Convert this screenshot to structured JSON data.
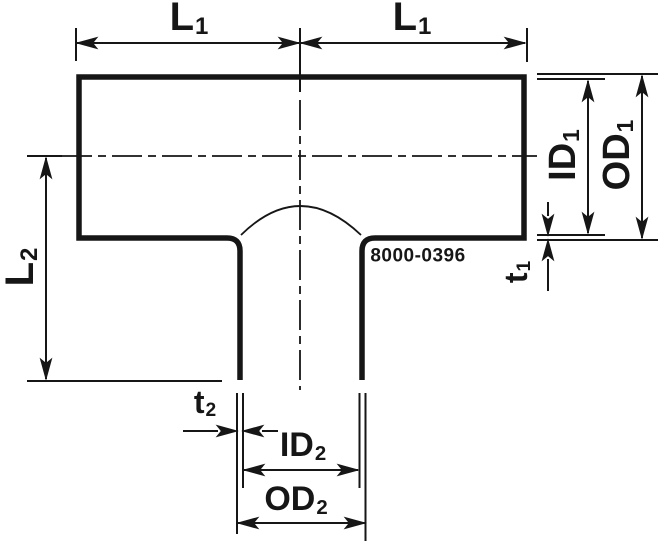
{
  "part_number": "8000-0396",
  "labels": {
    "l1_left": {
      "main": "L",
      "sub": "1"
    },
    "l1_right": {
      "main": "L",
      "sub": "1"
    },
    "l2": {
      "main": "L",
      "sub": "2"
    },
    "id1": {
      "main": "ID",
      "sub": "1"
    },
    "od1": {
      "main": "OD",
      "sub": "1"
    },
    "t1": {
      "main": "t",
      "sub": "1"
    },
    "t2": {
      "main": "t",
      "sub": "2"
    },
    "id2": {
      "main": "ID",
      "sub": "2"
    },
    "od2": {
      "main": "OD",
      "sub": "2"
    }
  },
  "colors": {
    "line": "#161616",
    "background": "#ffffff"
  }
}
